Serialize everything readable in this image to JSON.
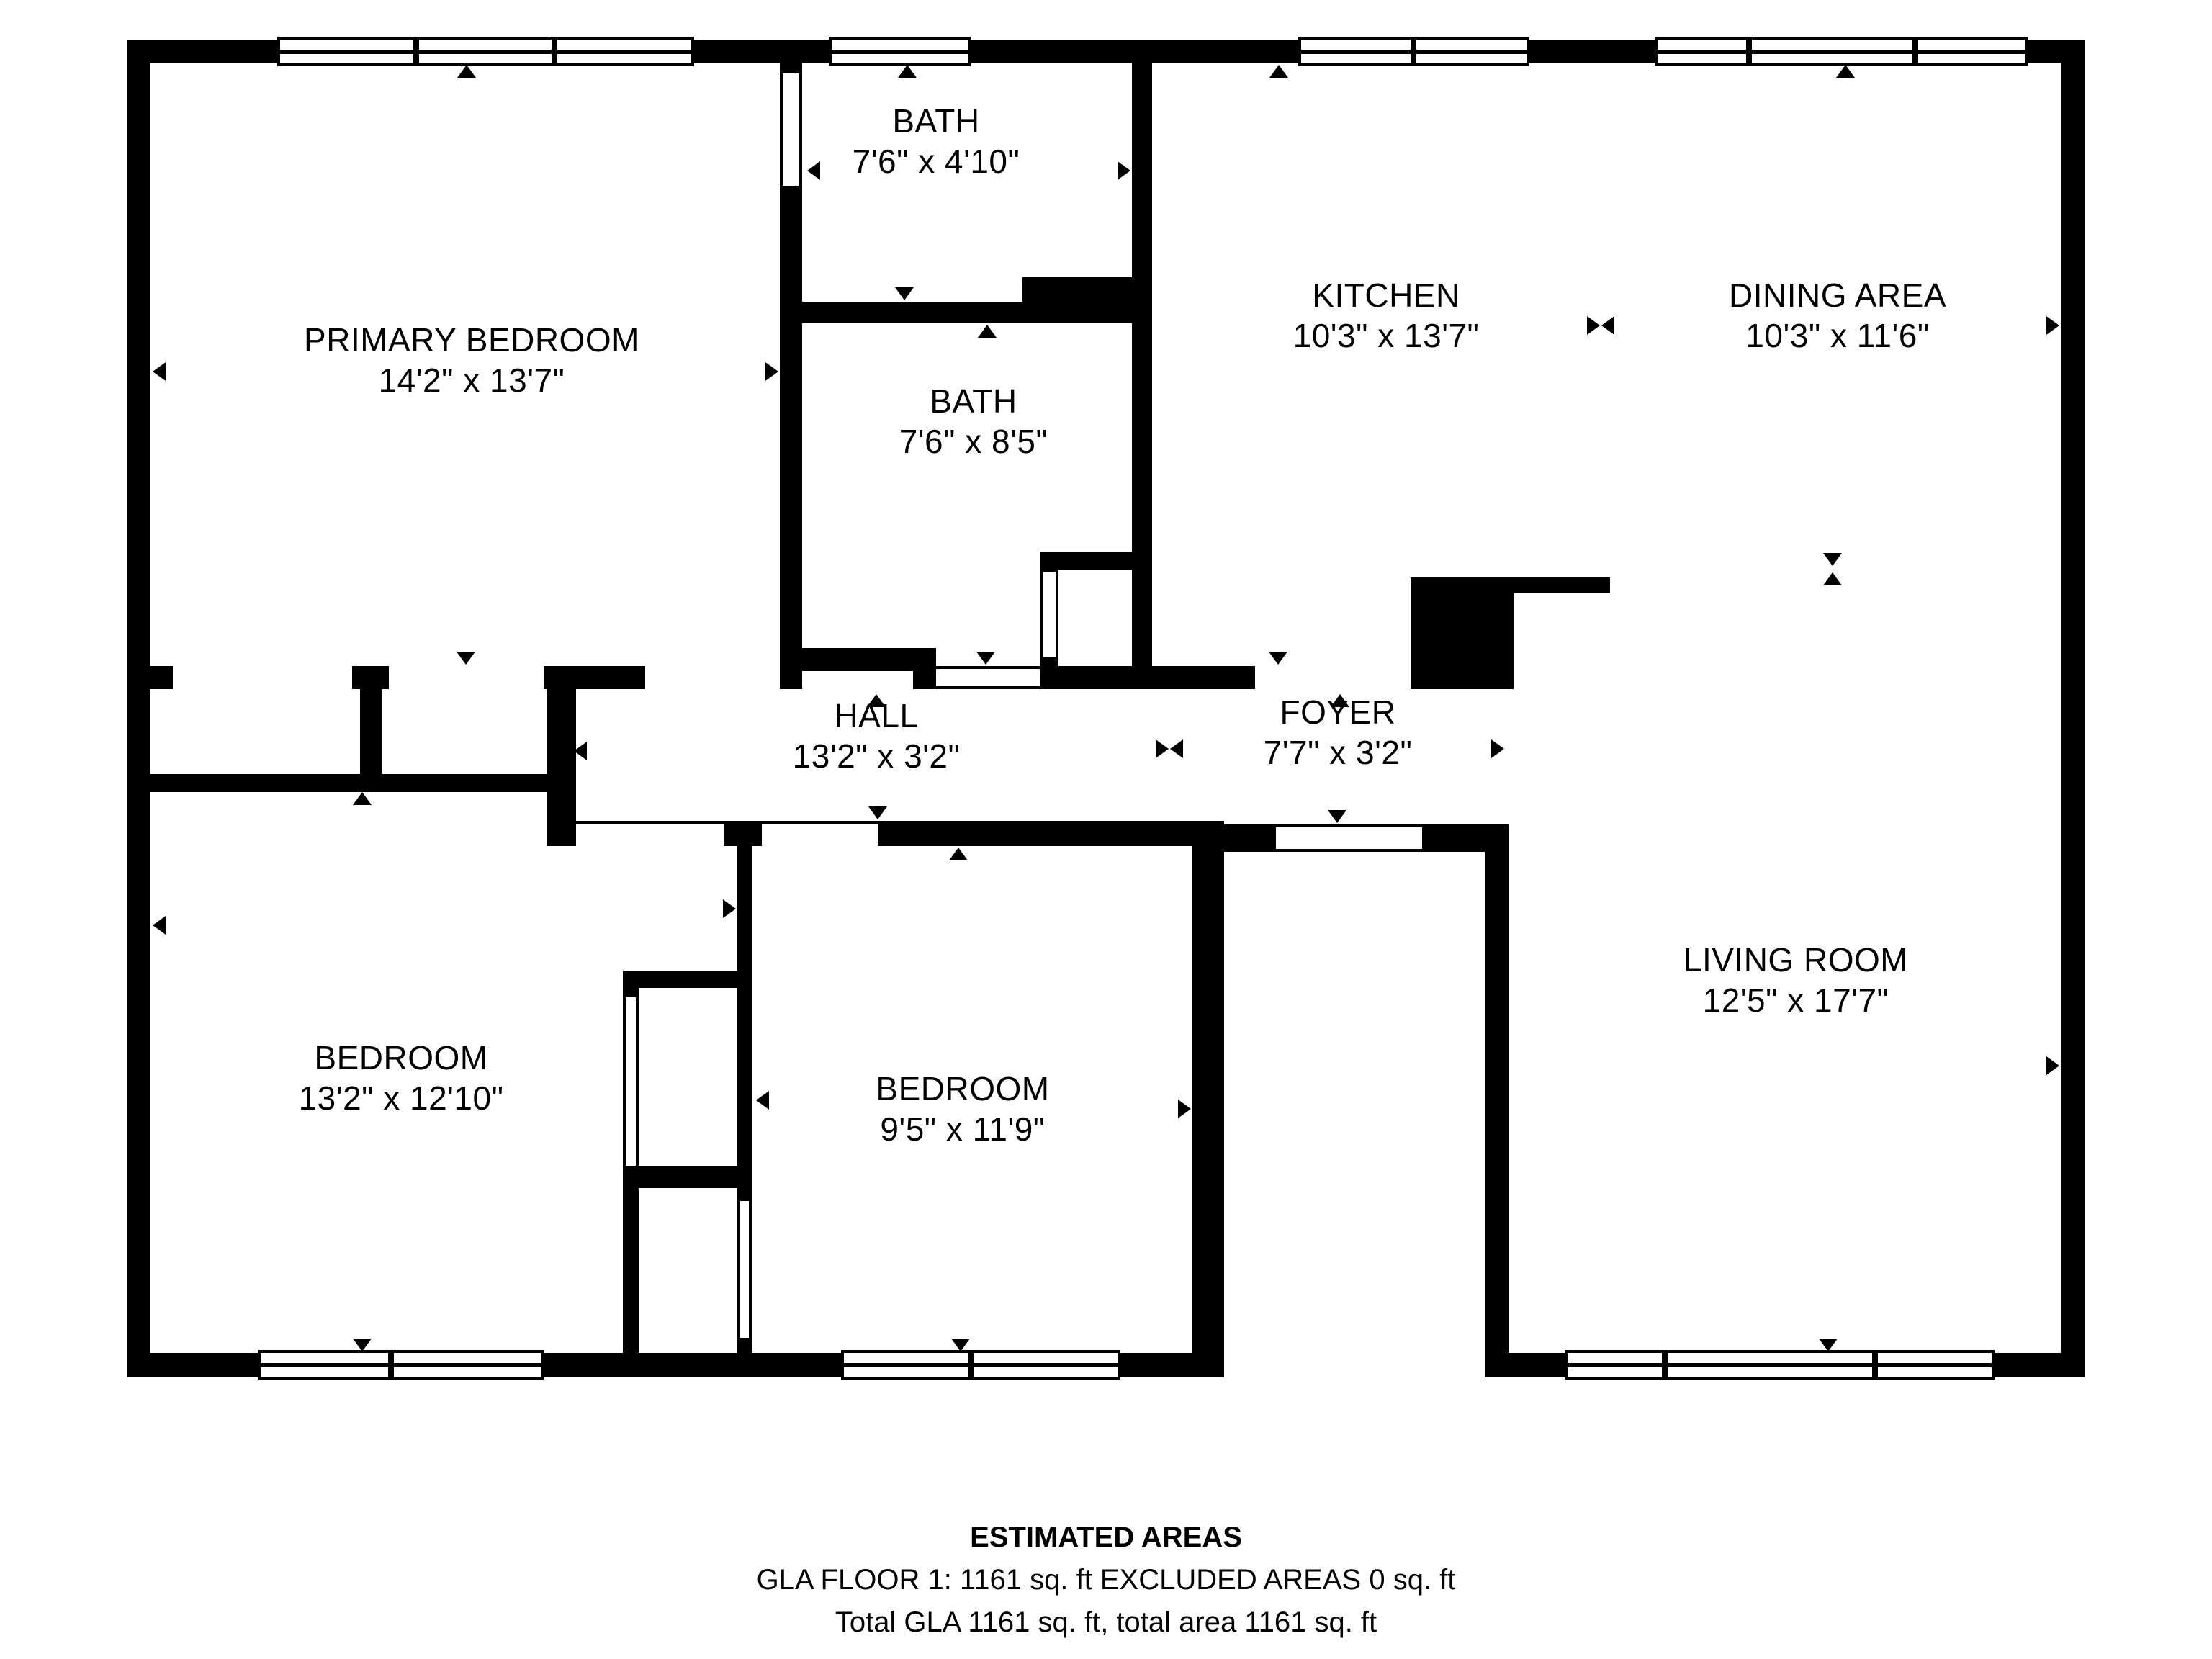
{
  "page": {
    "background_color": "#ffffff",
    "wall_color": "#000000",
    "text_color": "#000000"
  },
  "icons": {
    "dimension-arrow": "black triangle pointer (CSS border shape)",
    "window": "white bar with black frame and center glazing line",
    "door-opening": "white wall gap with thin jamb lines"
  },
  "rooms": [
    {
      "name": "PRIMARY BEDROOM",
      "dims": "14'2\" x 13'7\""
    },
    {
      "name": "BATH",
      "dims": "7'6\" x 4'10\""
    },
    {
      "name": "BATH",
      "dims": "7'6\" x 8'5\""
    },
    {
      "name": "KITCHEN",
      "dims": "10'3\" x 13'7\""
    },
    {
      "name": "DINING AREA",
      "dims": "10'3\" x 11'6\""
    },
    {
      "name": "HALL",
      "dims": "13'2\" x 3'2\""
    },
    {
      "name": "FOYER",
      "dims": "7'7\" x 3'2\""
    },
    {
      "name": "BEDROOM",
      "dims": "13'2\" x 12'10\""
    },
    {
      "name": "BEDROOM",
      "dims": "9'5\" x 11'9\""
    },
    {
      "name": "LIVING ROOM",
      "dims": "12'5\" x 17'7\""
    }
  ],
  "footer": {
    "title": "ESTIMATED AREAS",
    "line1": "GLA FLOOR 1: 1161 sq. ft EXCLUDED AREAS 0 sq. ft",
    "line2": "Total GLA 1161 sq. ft, total area 1161 sq. ft"
  }
}
